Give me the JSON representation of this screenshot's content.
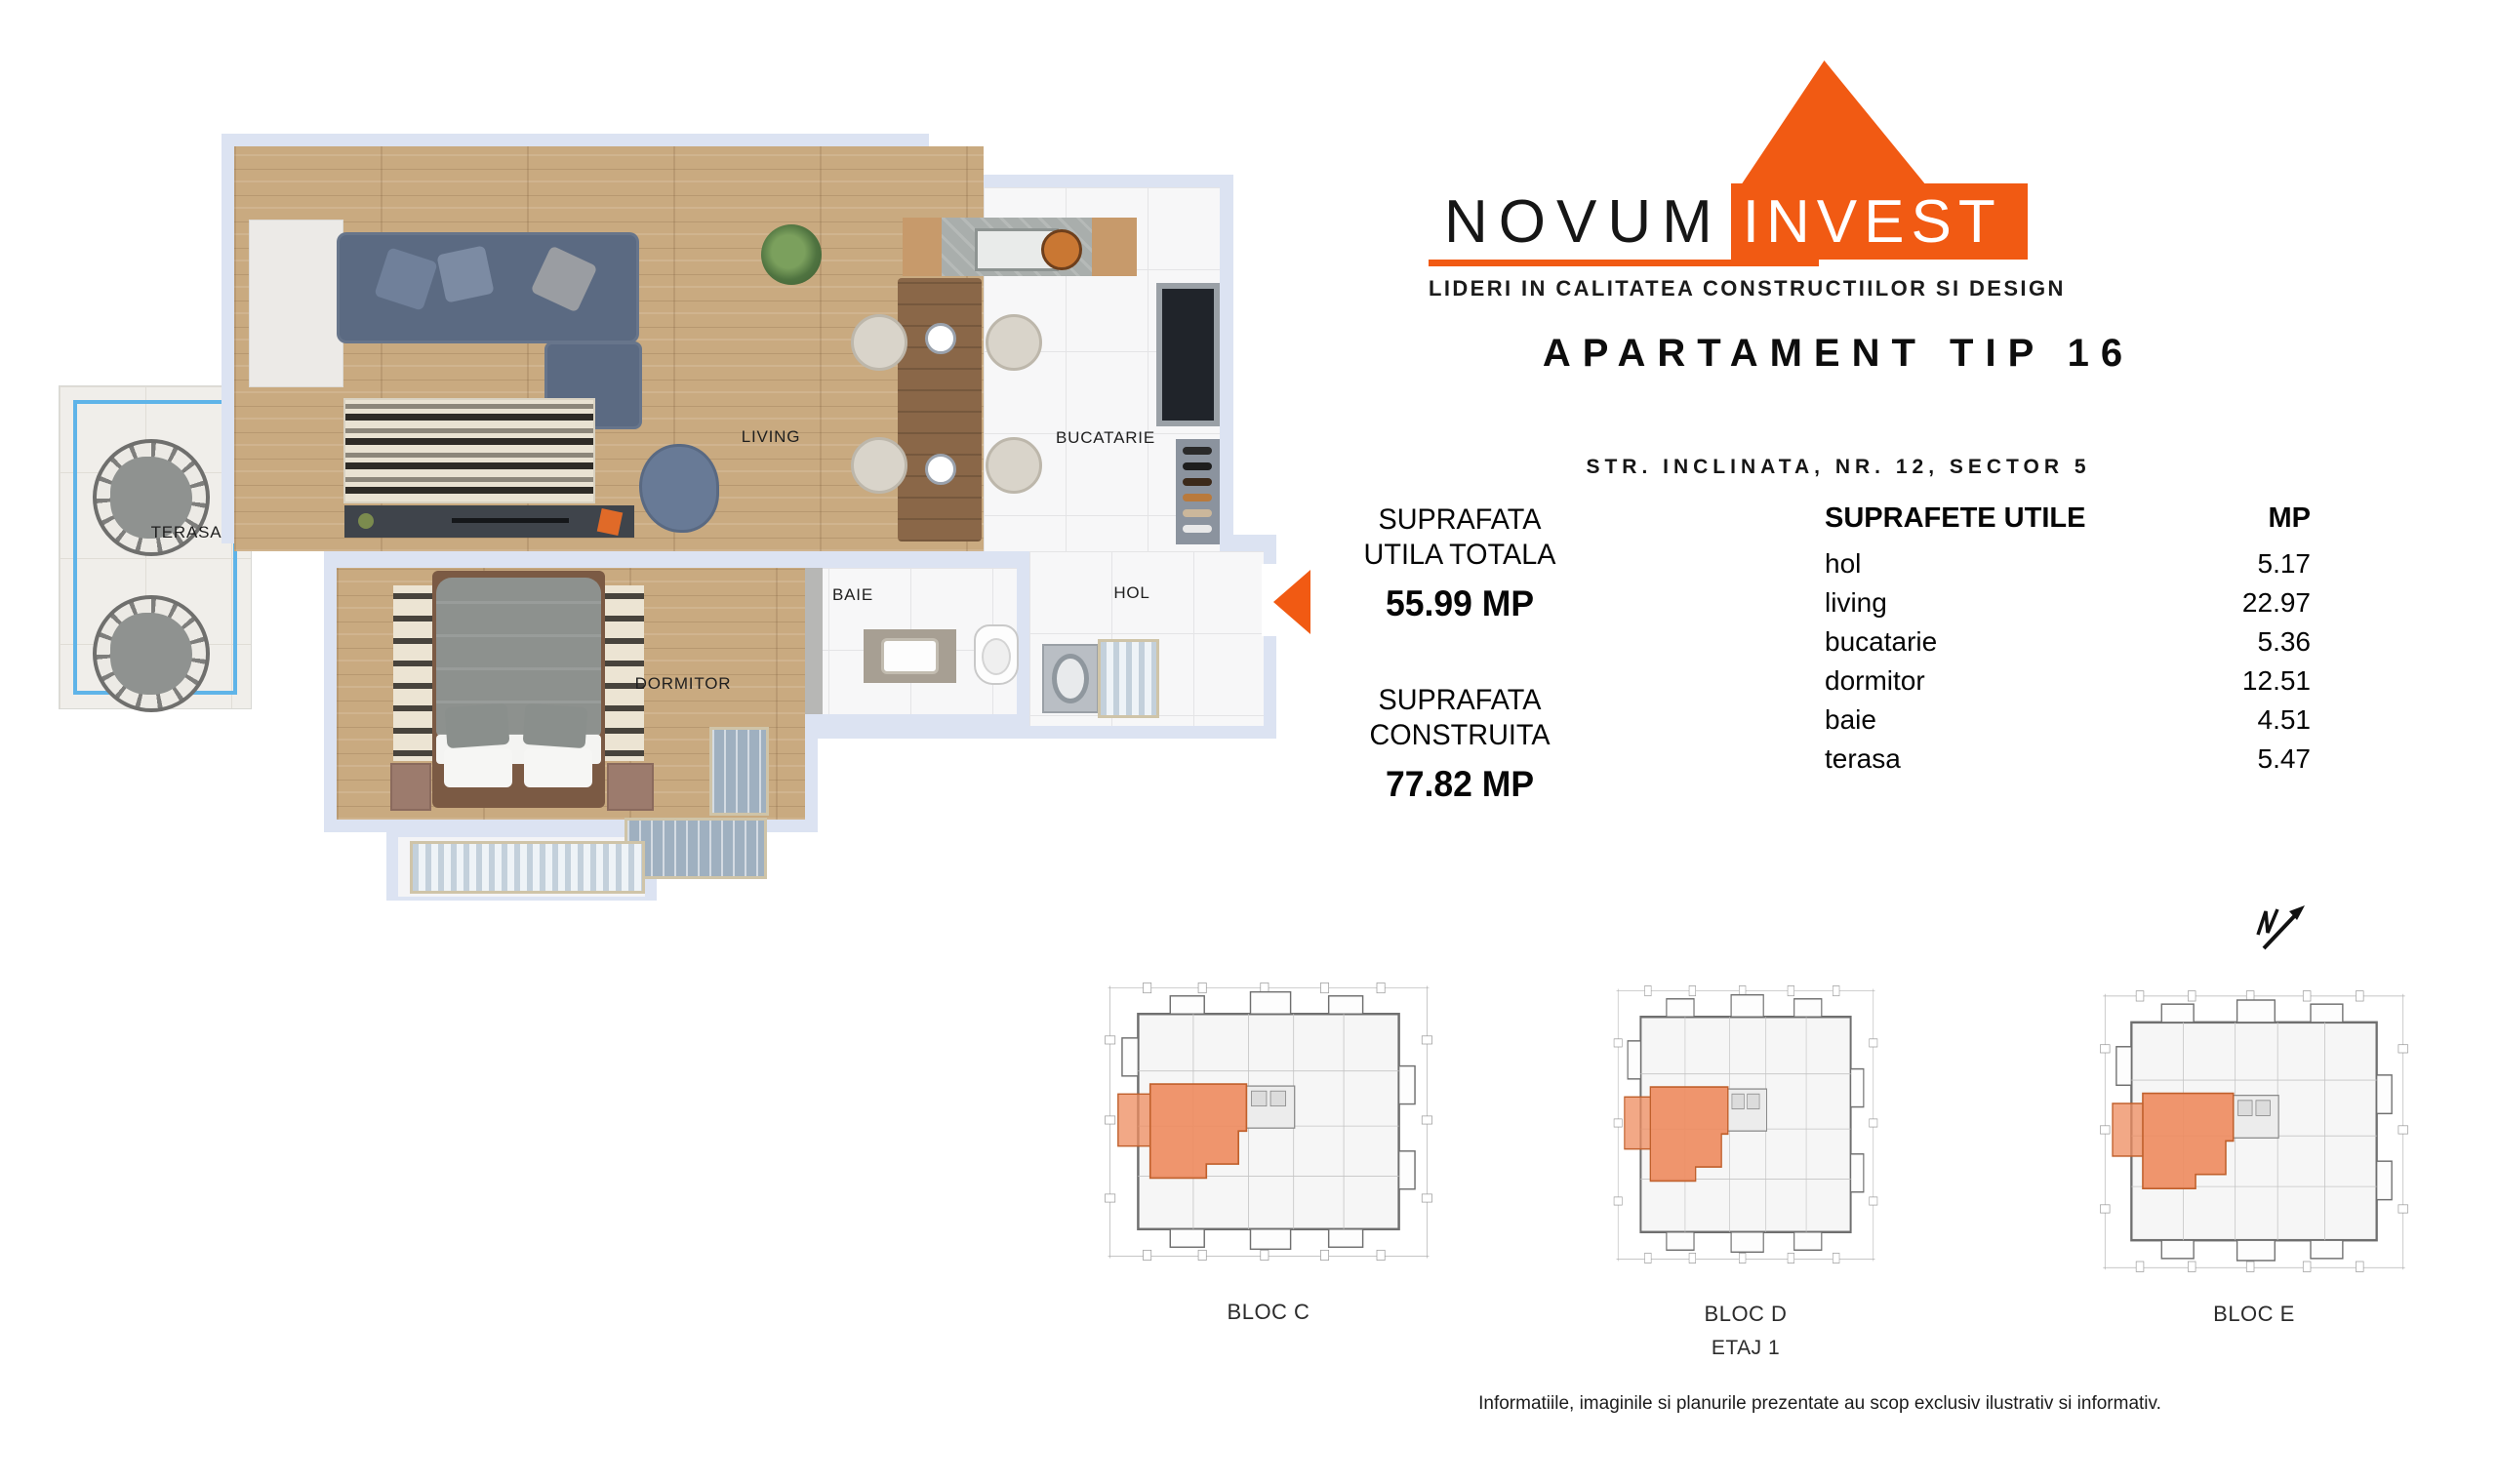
{
  "brand": {
    "name_primary": "NOVUM",
    "name_secondary": "INVEST",
    "tagline": "LIDERI IN CALITATEA CONSTRUCTIILOR SI DESIGN"
  },
  "header": {
    "title": "APARTAMENT TIP 16",
    "address": "STR. INCLINATA, NR. 12, SECTOR 5"
  },
  "summary": {
    "useful": {
      "line1": "SUPRAFATA",
      "line2": "UTILA TOTALA",
      "value": "55.99 MP"
    },
    "built": {
      "line1": "SUPRAFATA",
      "line2": "CONSTRUITA",
      "value": "77.82 MP"
    }
  },
  "surfaces": {
    "title": "SUPRAFETE UTILE",
    "unit": "MP",
    "rows": [
      {
        "label": "hol",
        "value": "5.17"
      },
      {
        "label": "living",
        "value": "22.97"
      },
      {
        "label": "bucatarie",
        "value": "5.36"
      },
      {
        "label": "dormitor",
        "value": "12.51"
      },
      {
        "label": "baie",
        "value": "4.51"
      },
      {
        "label": "terasa",
        "value": "5.47"
      }
    ]
  },
  "floorplan": {
    "labels": {
      "terasa": "TERASA",
      "living": "LIVING",
      "bucatarie": "BUCATARIE",
      "baie": "BAIE",
      "hol": "HOL",
      "dormitor": "DORMITOR"
    }
  },
  "blocks": {
    "items": [
      {
        "label": "BLOC C"
      },
      {
        "label": "BLOC D"
      },
      {
        "label": "BLOC E"
      }
    ],
    "floor": "ETAJ 1"
  },
  "footer": {
    "disclaimer": "Informatiile, imaginile si planurile prezentate au scop exclusiv ilustrativ si informativ."
  },
  "colors": {
    "accent": "#F15A13",
    "wall": "#DCE3F2",
    "terrace_rail": "#5FB4E8",
    "unit_highlight": "#EE8B5E"
  }
}
